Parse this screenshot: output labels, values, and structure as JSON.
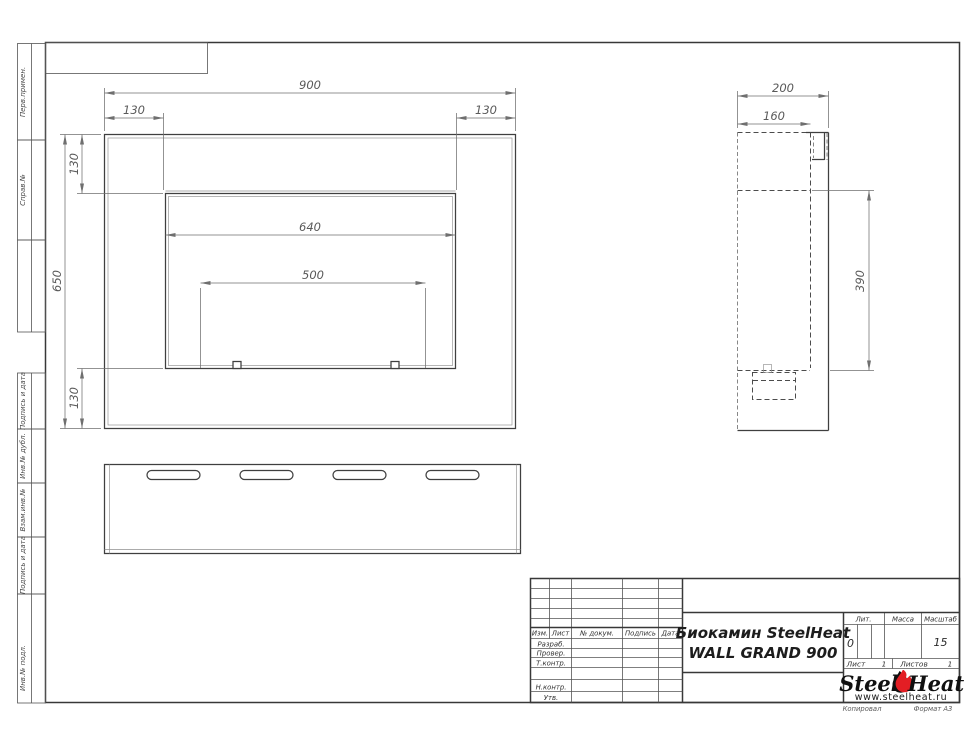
{
  "strip": {
    "perv": "Перв.примен.",
    "sprav": "Справ.№",
    "podpis1": "Подпись и дата",
    "inv_dubl": "Инв.№ дубл.",
    "vzam": "Взам.инв.№",
    "podpis2": "Подпись и дата",
    "inv_podl": "Инв.№ подл."
  },
  "dims": {
    "front_width": "900",
    "front_height": "650",
    "top_margin_left": "130",
    "top_margin_right": "130",
    "left_margin_top": "130",
    "left_margin_bottom": "130",
    "opening_width": "640",
    "burner_width": "500",
    "side_depth": "200",
    "side_inner_depth": "160",
    "side_opening_height": "390"
  },
  "title_block": {
    "col_izm": "Изм.",
    "col_list": "Лист",
    "col_doc": "№ докум.",
    "col_sign": "Подпись",
    "col_date": "Дата",
    "row_razrab": "Разраб.",
    "row_prover": "Провер.",
    "row_tkontr": "Т.контр.",
    "row_nkontr": "Н.контр.",
    "row_utv": "Утв.",
    "title_line1": "Биокамин SteelHeat",
    "title_line2": "WALL GRAND 900",
    "lit_label": "Лит.",
    "massa_label": "Масса",
    "masshtab_label": "Масштаб",
    "lit_value": "0",
    "masshtab_value": "15",
    "list_label": "Лист",
    "list_value": "1",
    "listov_label": "Листов",
    "listov_value": "1",
    "kopiroval": "Копировал",
    "format": "Формат А3"
  },
  "logo": {
    "steel": "Steel",
    "heat": "Heat",
    "url": "www.steelheat.ru",
    "flame_color": "#e31e24"
  },
  "colors": {
    "contour": "#3f3f3f",
    "dimension": "#6f6f6f",
    "frame": "#383838",
    "accent_red": "#e31e24"
  }
}
